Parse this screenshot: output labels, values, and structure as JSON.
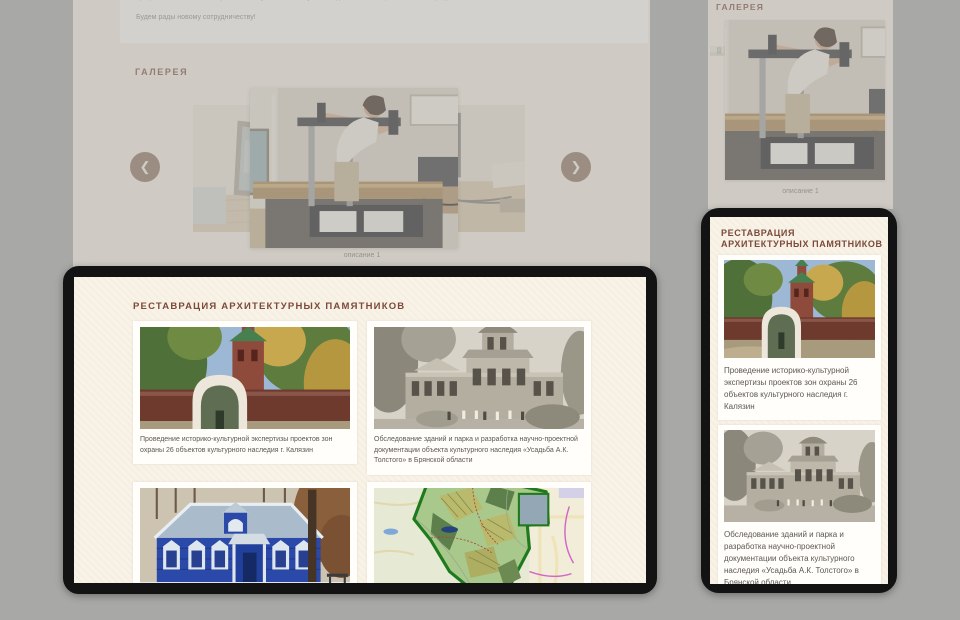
{
  "stage": {
    "background_color": "#a8a8a6"
  },
  "desktop_view": {
    "intro_line1": "профессиональным и современным музейным и искусствоведческим сообществом своей среды.",
    "intro_line2": "Будем рады новому сотрудничеству!",
    "gallery_title": "ГАЛЕРЕЯ",
    "slide_caption": "описание 1",
    "prev_icon": "❮",
    "next_icon": "❯",
    "current_slide_image": "book-scanner-restoration-photo",
    "side_slide_images": [
      "studio-interior-photo",
      "work-desk-photo"
    ]
  },
  "restoration_section": {
    "title": "РЕСТАВРАЦИЯ АРХИТЕКТУРНЫХ ПАМЯТНИКОВ",
    "cards": [
      {
        "image": "church-gate-photo",
        "caption": "Проведение историко-культурной экспертизы проектов  зон охраны 26 объектов культурного наследия г. Калязин"
      },
      {
        "image": "manor-archive-photo",
        "caption": "Обследование зданий и парка и разработка научно-проектной документации объекта культурного наследия «Усадьба А.К. Толстого» в Брянской области"
      },
      {
        "image": "blue-wooden-house-photo",
        "caption": ""
      },
      {
        "image": "protected-territory-map",
        "caption": ""
      }
    ]
  },
  "mobile_view": {
    "gallery_title": "ГАЛЕРЕЯ",
    "slide_caption": "описание 1"
  },
  "colors": {
    "heading_brown": "#7b4a39",
    "page_cream": "#f8f2e7",
    "card_white": "#fffefa",
    "caption_gray": "#5d5750",
    "device_frame": "#131313",
    "nav_arrow": "#8a6f5b"
  }
}
